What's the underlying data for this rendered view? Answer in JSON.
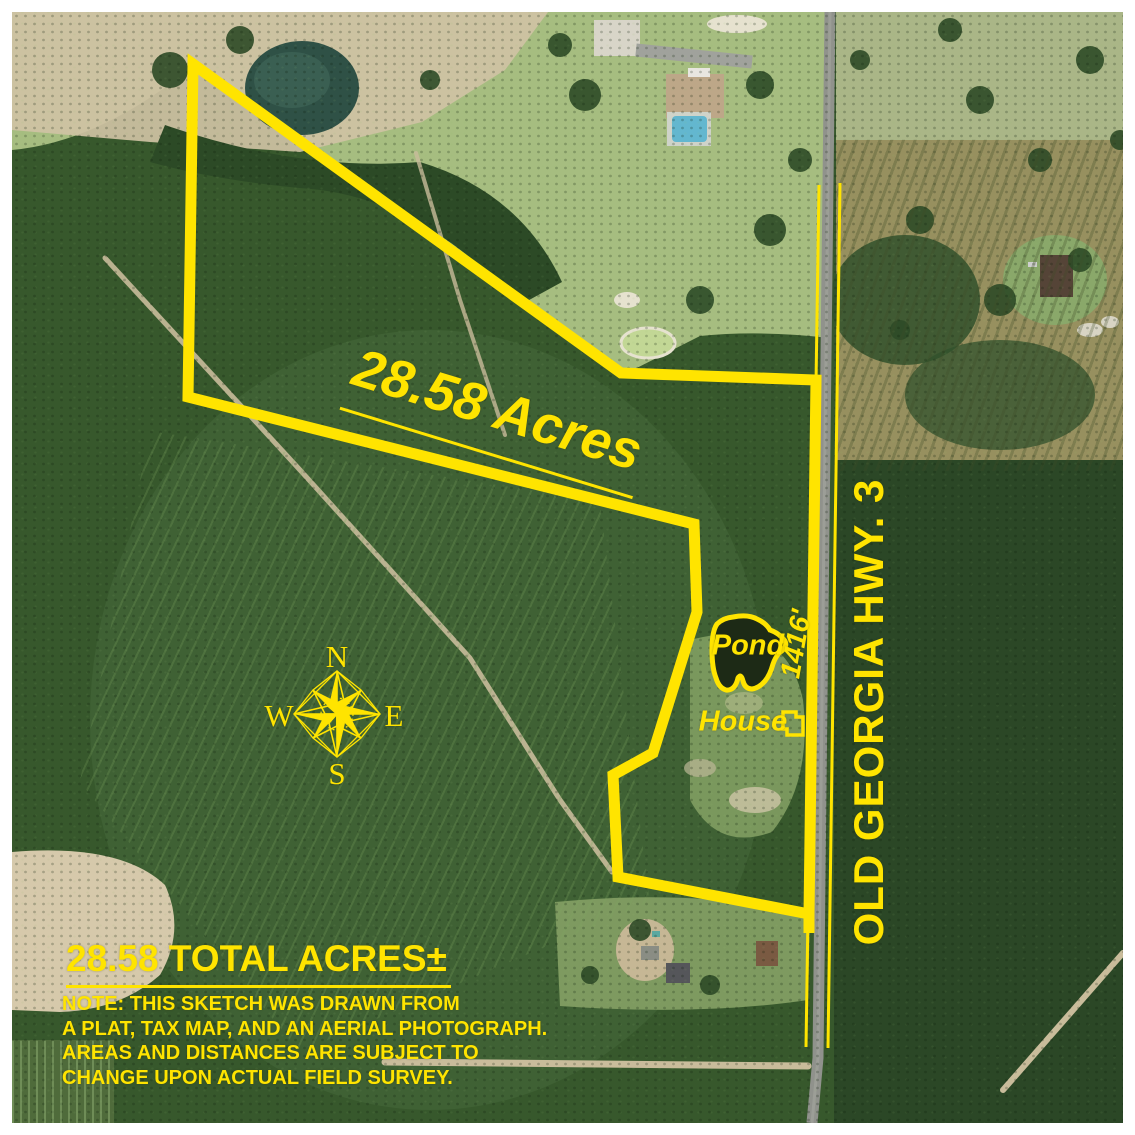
{
  "labels": {
    "acreage": "28.58 Acres",
    "highway": "OLD GEORGIA HWY. 3",
    "frontage_distance": "1416'",
    "pond": "Pond",
    "house": "House",
    "total_acres": "28.58 TOTAL ACRES±"
  },
  "note_lines": [
    "NOTE: THIS SKETCH WAS DRAWN FROM",
    "A PLAT, TAX MAP, AND AN AERIAL PHOTOGRAPH.",
    "AREAS AND DISTANCES ARE SUBJECT TO",
    "CHANGE UPON ACTUAL FIELD SURVEY."
  ],
  "compass": {
    "n": "N",
    "e": "E",
    "s": "S",
    "w": "W"
  },
  "colors": {
    "annotation_yellow": "#FFE400",
    "forest_dark_green": "#2c4a26",
    "field_light_green": "#a6bd80",
    "dirt_tan": "#cfc2a4",
    "road_gray": "#90928c",
    "pond_dark": "#1d2a16"
  }
}
